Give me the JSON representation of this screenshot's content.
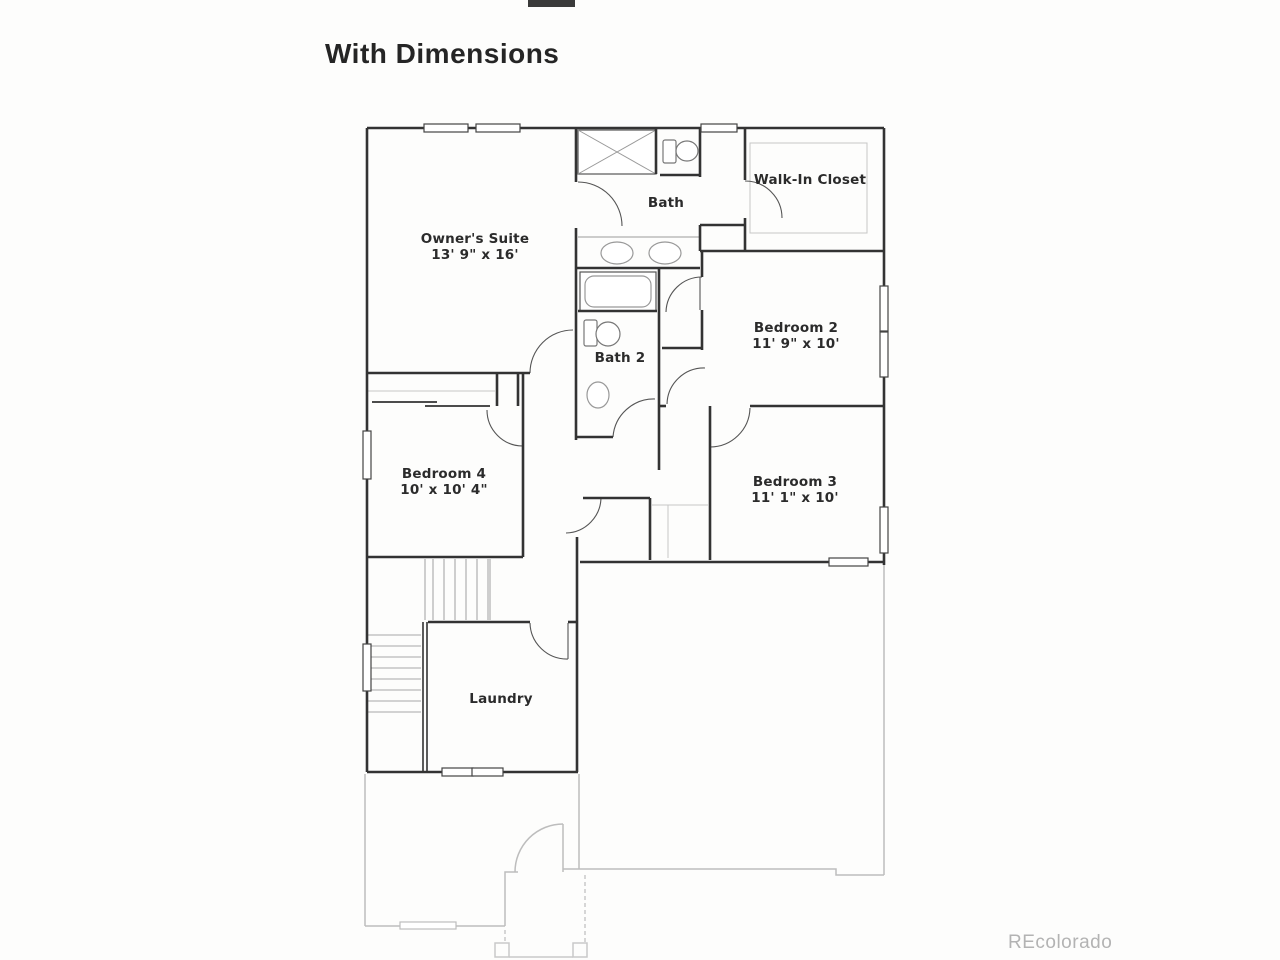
{
  "title": "With Dimensions",
  "watermark": "REcolorado",
  "rooms": [
    {
      "name": "Owner's Suite",
      "dims": "13' 9\" x 16'",
      "x": 475,
      "y": 243
    },
    {
      "name": "Bath",
      "dims": "",
      "x": 666,
      "y": 207
    },
    {
      "name": "Walk-In Closet",
      "dims": "",
      "x": 810,
      "y": 184
    },
    {
      "name": "Bedroom 2",
      "dims": "11' 9\" x 10'",
      "x": 796,
      "y": 332
    },
    {
      "name": "Bath 2",
      "dims": "",
      "x": 620,
      "y": 362
    },
    {
      "name": "Bedroom 4",
      "dims": "10' x 10' 4\"",
      "x": 444,
      "y": 478
    },
    {
      "name": "Bedroom 3",
      "dims": "11' 1\" x 10'",
      "x": 795,
      "y": 486
    },
    {
      "name": "Laundry",
      "dims": "",
      "x": 501,
      "y": 703
    }
  ],
  "colors": {
    "wall": "#333333",
    "fixture": "#777777",
    "door_arc": "#555555",
    "stair_line": "#a8a8a8",
    "ground_floor": "#bdbdbd",
    "shelf": "#c6c6c6",
    "title_text": "#252525",
    "watermark_text": "#b3b3b3"
  }
}
